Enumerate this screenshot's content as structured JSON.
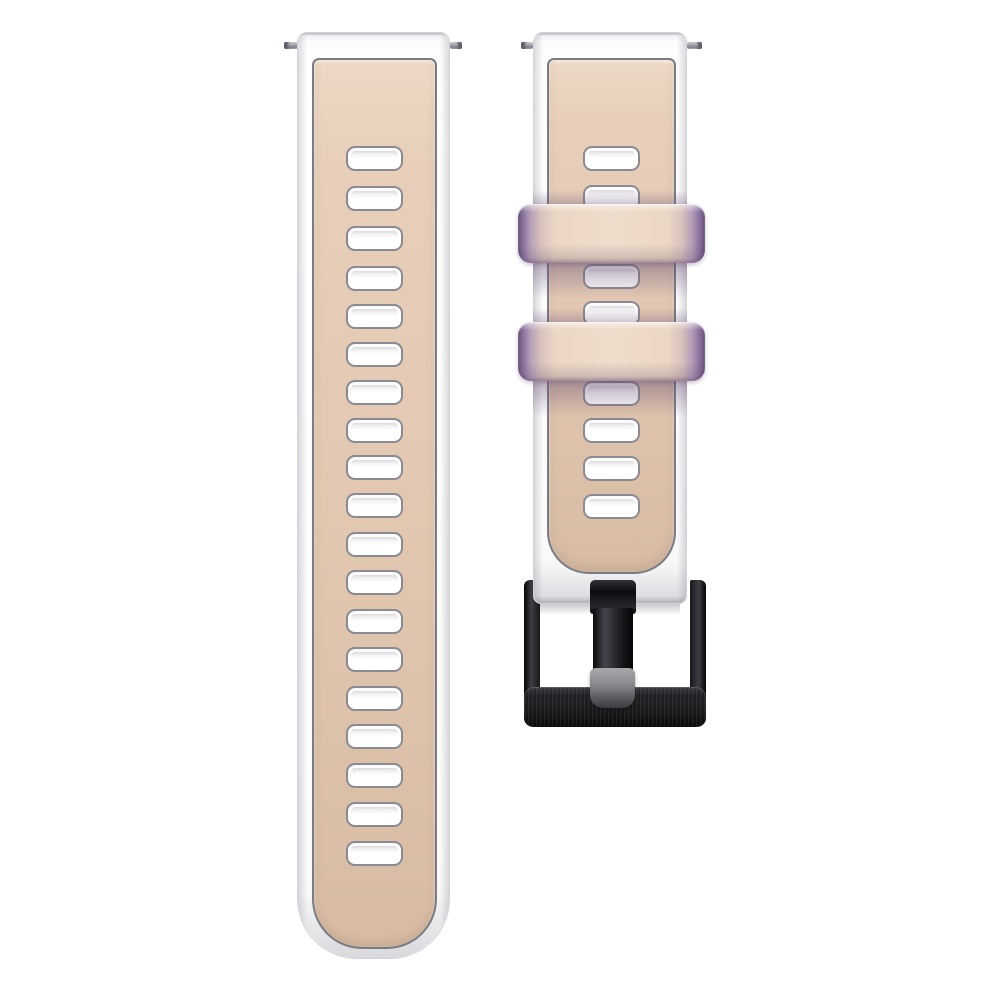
{
  "product": {
    "description": "Two-piece silicone watch strap: beige (khaki) center with white edges, ventilation slot holes, two purple-tinted keeper loops, black metal pin buckle, quick-release spring bars, on plain white background",
    "background_color": "#ffffff"
  },
  "palette": {
    "strap_edge_white": "#fbfbfc",
    "strap_border_gray": "#d2d2d8",
    "panel_beige_top": "#edd9c6",
    "panel_beige_mid": "#e3c9b3",
    "panel_beige_bottom": "#d7bba3",
    "panel_outline": "#7b7b83",
    "hole_border": "#8a8a92",
    "hole_fill": "#ffffff",
    "keeper_beige": "#efdcca",
    "keeper_purple_light": "#a08bb0",
    "keeper_purple_dark": "#645075",
    "buckle_black": "#1c1c1f",
    "buckle_highlight": "#3d3d44",
    "tongue_tip_gray": "#a8a8ab",
    "pin_metal_gray": "#a9a9b1"
  },
  "left_strap": {
    "body": {
      "x": 297,
      "y": 32,
      "w": 153,
      "h": 927
    },
    "panel": {
      "x": 14,
      "y": 25,
      "w": 125,
      "h": 891
    },
    "hole": {
      "w": 57,
      "h": 25
    },
    "hole_count": 19,
    "hole_ys": [
      145,
      185,
      225,
      265,
      303,
      341,
      379,
      417,
      454,
      492,
      531,
      569,
      608,
      646,
      685,
      723,
      762,
      801,
      840
    ]
  },
  "right_strap": {
    "body": {
      "x": 533,
      "y": 32,
      "w": 154,
      "h": 572
    },
    "panel": {
      "x": 13,
      "y": 25,
      "w": 129,
      "h": 516
    },
    "hole": {
      "w": 57,
      "h": 25
    },
    "visible_hole_count": 8,
    "hole_ys": [
      145,
      184,
      263,
      300,
      380,
      417,
      455,
      493
    ],
    "end_shadow": {
      "x": 540,
      "y": 602,
      "w": 140,
      "h": 13
    },
    "keepers": [
      {
        "x": 518,
        "y": 204,
        "w": 187,
        "h": 59
      },
      {
        "x": 518,
        "y": 322,
        "w": 187,
        "h": 59
      }
    ],
    "keeper_count": 2
  },
  "buckle": {
    "frame": {
      "x": 524,
      "y": 580,
      "w": 182,
      "h": 147
    },
    "tongue": {
      "x": 590,
      "y": 580,
      "w": 46,
      "h": 128
    },
    "color": "black"
  },
  "spring_bars": [
    {
      "x": 284,
      "y": 42,
      "w": 14,
      "h": 7,
      "cap": "left"
    },
    {
      "x": 450,
      "y": 42,
      "w": 12,
      "h": 7,
      "cap": "right"
    },
    {
      "x": 521,
      "y": 42,
      "w": 12,
      "h": 7,
      "cap": "left"
    },
    {
      "x": 687,
      "y": 42,
      "w": 15,
      "h": 7,
      "cap": "right"
    }
  ]
}
